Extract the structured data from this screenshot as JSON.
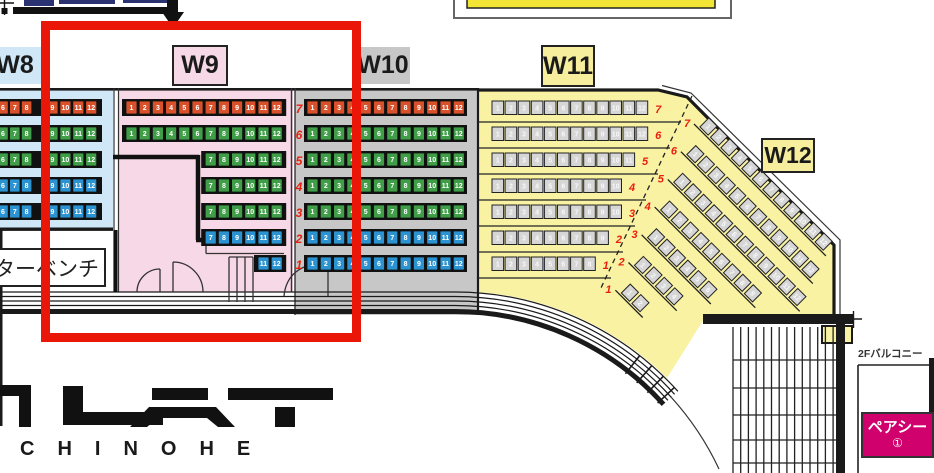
{
  "labels": {
    "w8": "W8",
    "w9": "W9",
    "w10": "W10",
    "w11": "W11",
    "w12": "W12"
  },
  "texts": {
    "bench": "ターベンチ",
    "balcony": "2Fバルコニー",
    "pair_seat": "ペアシー",
    "pair_seat_number": "①",
    "logo": "CHINOHE"
  },
  "colors": {
    "seat_orange": "#d8512a",
    "seat_green": "#3f9e47",
    "seat_blue": "#2b93d1",
    "seat_gray": "#d6d6d6",
    "section_w8": "#cfe7f7",
    "section_w9": "#f7d8e6",
    "section_w10": "#c7c7c7",
    "section_yellow": "#f9f2a2",
    "label_yellow": "#f6ee9c",
    "highlight_red": "#ea1608",
    "pair_magenta": "#d0006d",
    "navy": "#2a3272",
    "top_bar_yellow": "#f2e535",
    "row_number_red": "#e8210f"
  },
  "sections": {
    "w8": {
      "rows": [
        {
          "color": "orange",
          "groups": [
            [
              5,
              6,
              7,
              8
            ],
            [
              9,
              10,
              11,
              12
            ]
          ]
        },
        {
          "color": "green",
          "groups": [
            [
              5,
              6,
              7,
              8
            ],
            [
              9,
              10,
              11,
              12
            ]
          ]
        },
        {
          "color": "green",
          "groups": [
            [
              5,
              6,
              7,
              8
            ],
            [
              9,
              10,
              11,
              12
            ]
          ]
        },
        {
          "color": "blue",
          "groups": [
            [
              5,
              6,
              7,
              8
            ],
            [
              9,
              10,
              11,
              12
            ]
          ]
        },
        {
          "color": "blue",
          "groups": [
            [
              5,
              6,
              7,
              8
            ],
            [
              9,
              10,
              11,
              12
            ]
          ]
        }
      ]
    },
    "w9": {
      "rows": [
        {
          "color": "orange",
          "seats": [
            1,
            2,
            3,
            4,
            5,
            6,
            7,
            8,
            9,
            10,
            11,
            12
          ]
        },
        {
          "color": "green",
          "seats": [
            1,
            2,
            3,
            4,
            5,
            6,
            7,
            8,
            9,
            10,
            11,
            12
          ]
        },
        {
          "color": "green",
          "seats": [
            7,
            8,
            9,
            10,
            11,
            12
          ]
        },
        {
          "color": "green",
          "seats": [
            7,
            8,
            9,
            10,
            11,
            12
          ]
        },
        {
          "color": "green",
          "seats": [
            7,
            8,
            9,
            10,
            11,
            12
          ]
        },
        {
          "color": "blue",
          "seats": [
            7,
            8,
            9,
            10,
            11,
            12
          ]
        },
        {
          "color": "blue",
          "seats": [
            11,
            12
          ]
        }
      ]
    },
    "w10": {
      "rows": [
        {
          "num": "7",
          "color": "orange",
          "seats": [
            1,
            2,
            3,
            4,
            5,
            6,
            7,
            8,
            9,
            10,
            11,
            12
          ]
        },
        {
          "num": "6",
          "color": "green",
          "seats": [
            1,
            2,
            3,
            4,
            5,
            6,
            7,
            8,
            9,
            10,
            11,
            12
          ]
        },
        {
          "num": "5",
          "color": "green",
          "seats": [
            1,
            2,
            3,
            4,
            5,
            6,
            7,
            8,
            9,
            10,
            11,
            12
          ]
        },
        {
          "num": "4",
          "color": "green",
          "seats": [
            1,
            2,
            3,
            4,
            5,
            6,
            7,
            8,
            9,
            10,
            11,
            12
          ]
        },
        {
          "num": "3",
          "color": "green",
          "seats": [
            1,
            2,
            3,
            4,
            5,
            6,
            7,
            8,
            9,
            10,
            11,
            12
          ]
        },
        {
          "num": "2",
          "color": "blue",
          "seats": [
            1,
            2,
            3,
            4,
            5,
            6,
            7,
            8,
            9,
            10,
            11,
            12
          ]
        },
        {
          "num": "1",
          "color": "blue",
          "seats": [
            1,
            2,
            3,
            4,
            5,
            6,
            7,
            8,
            9,
            10,
            11,
            12
          ]
        }
      ]
    },
    "w11": {
      "rows": [
        {
          "num": "7",
          "count": 12
        },
        {
          "num": "6",
          "count": 12
        },
        {
          "num": "5",
          "count": 11
        },
        {
          "num": "4",
          "count": 10
        },
        {
          "num": "3",
          "count": 10
        },
        {
          "num": "2",
          "count": 9
        },
        {
          "num": "1",
          "count": 8
        }
      ]
    },
    "w12": {
      "rows": [
        {
          "num": "7",
          "count": 12
        },
        {
          "num": "6",
          "count": 12
        },
        {
          "num": "5",
          "count": 12
        },
        {
          "num": "4",
          "count": 9
        },
        {
          "num": "3",
          "count": 6
        },
        {
          "num": "2",
          "count": 4
        },
        {
          "num": "1",
          "count": 2
        }
      ]
    }
  }
}
